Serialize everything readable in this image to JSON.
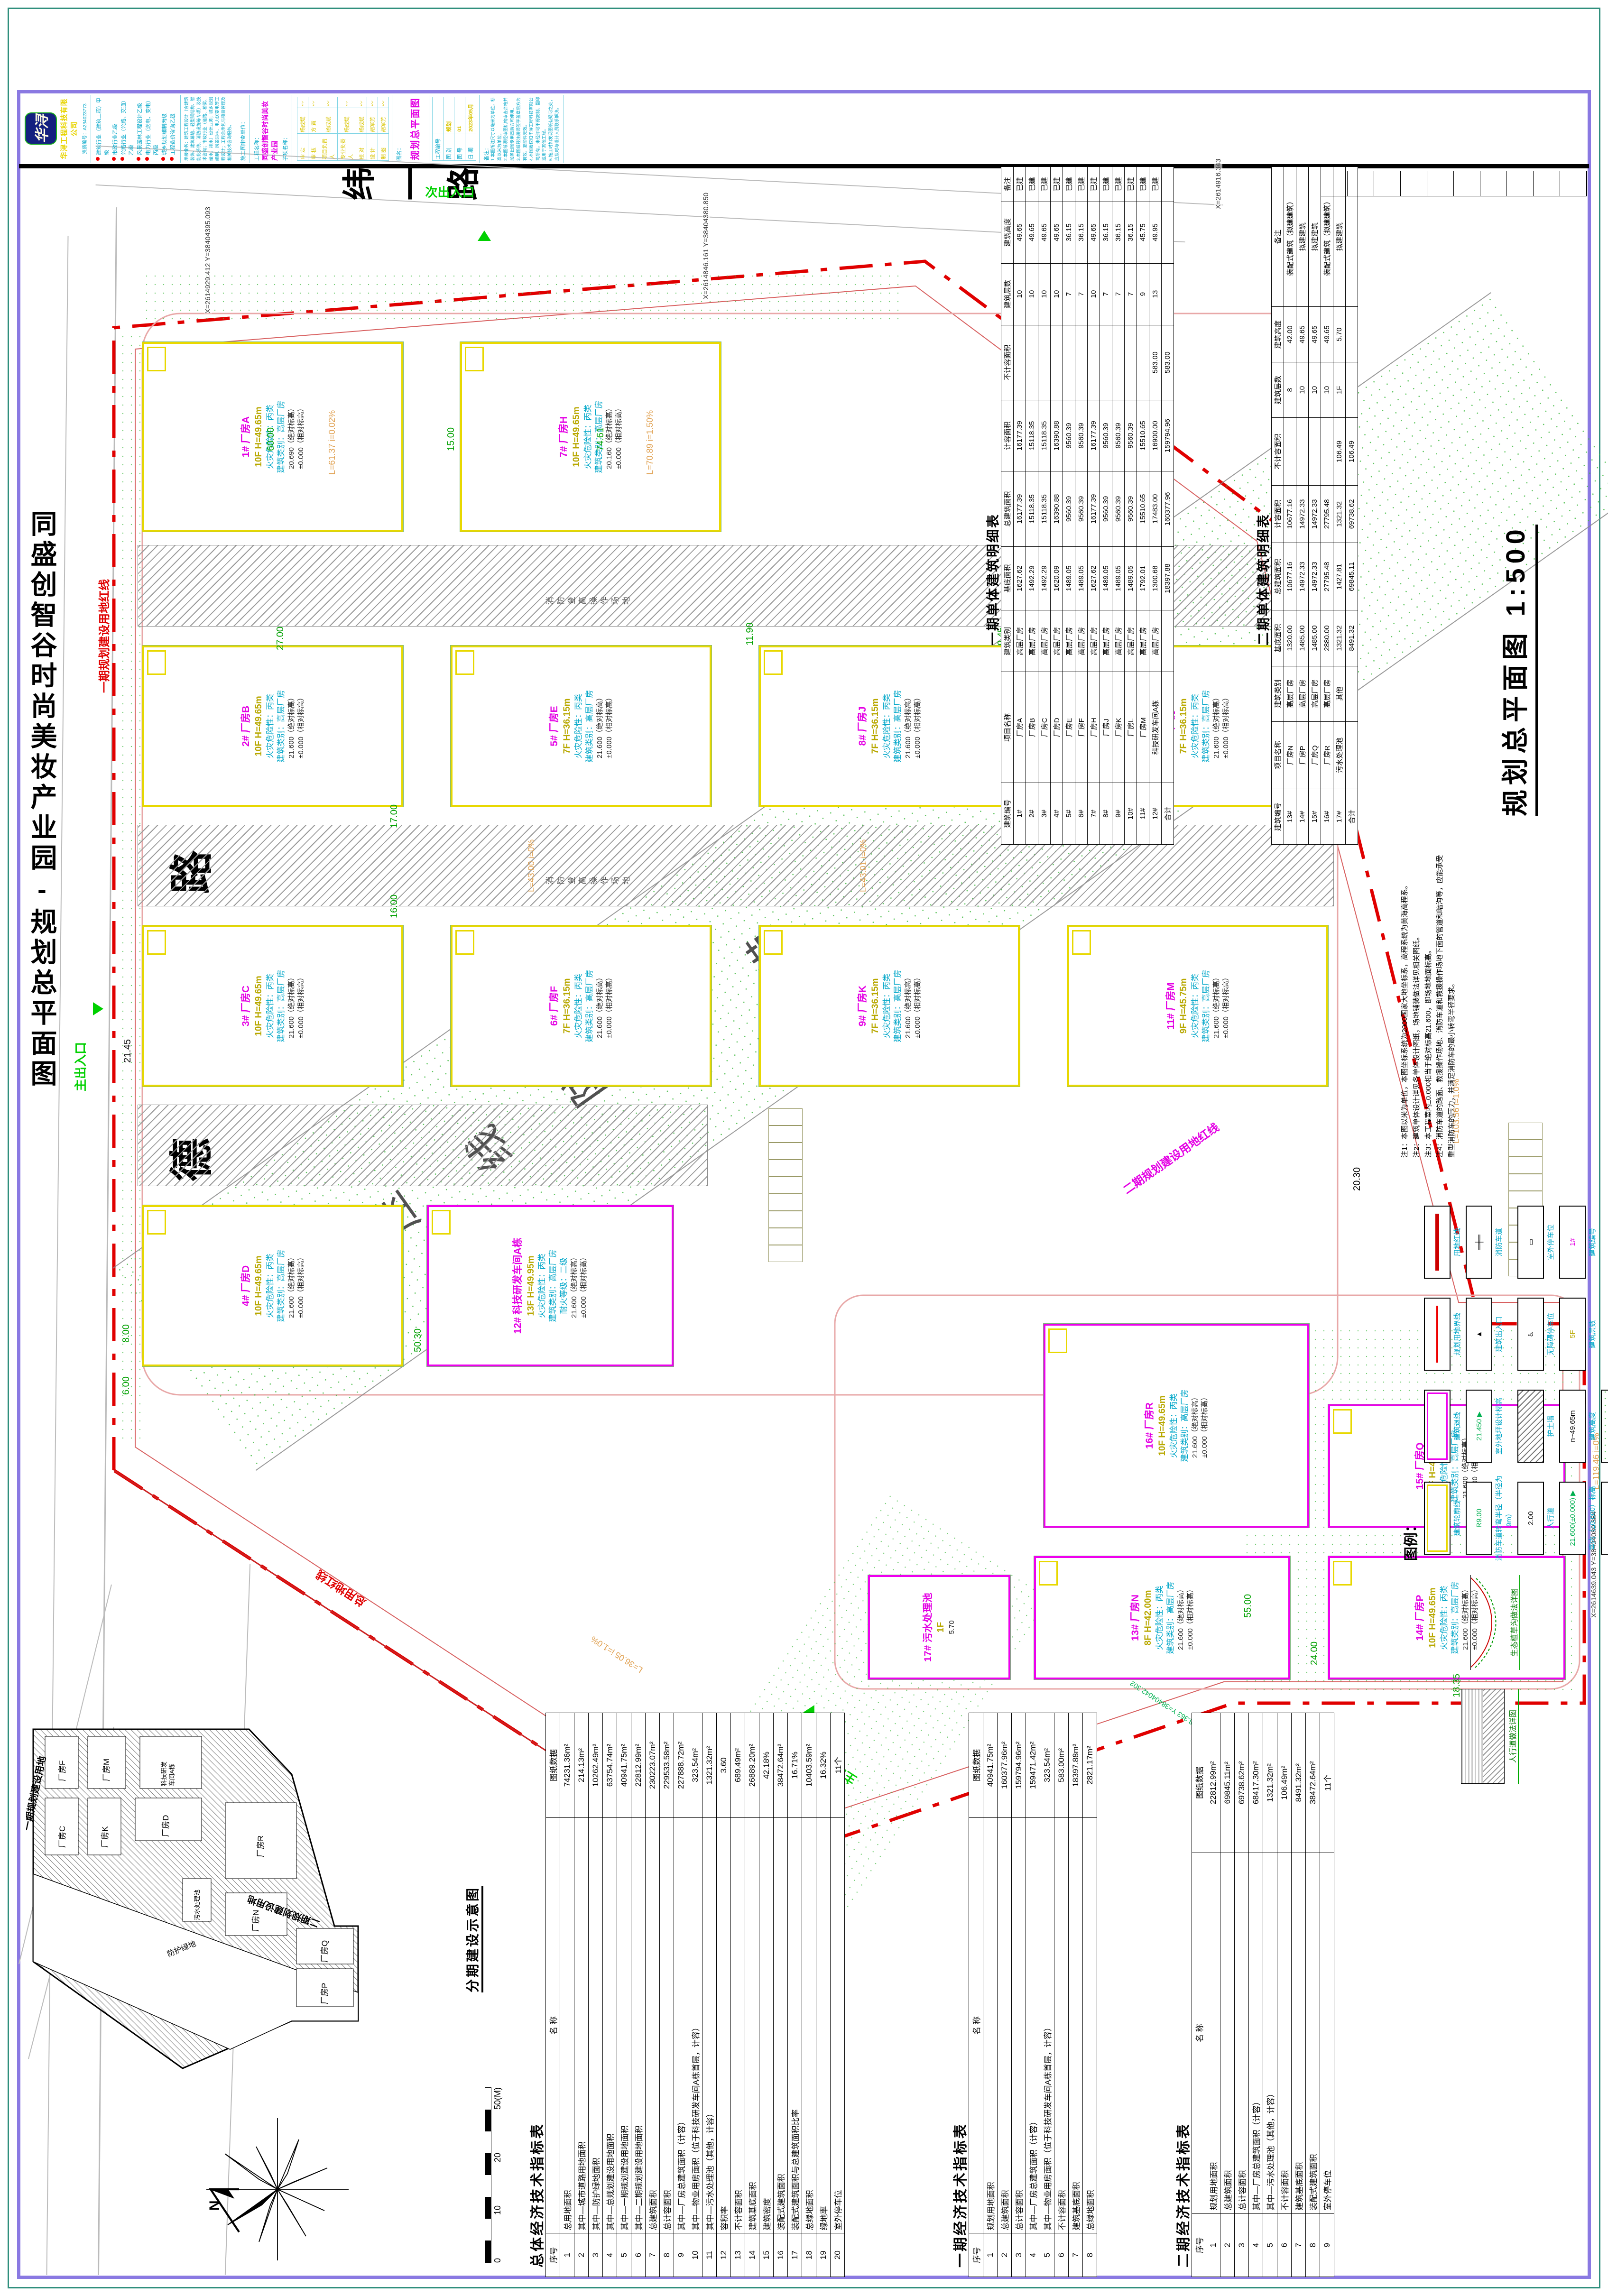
{
  "sheet": {
    "margin_title": "同盛创智谷时尚美妆产业园-规划总平面图",
    "plan_title": "规划总平面图 1:500"
  },
  "company": {
    "logo_text": "华浔",
    "name": "华浔工程科技有限公司",
    "reg_no": "资质编号：A234023773",
    "qualifications": [
      "建筑行业（建筑工程）甲级",
      "市政行业乙级",
      "公路行业（公路、交通）乙级",
      "风景园林工程设计乙级",
      "电力行业（送电、变电）丙级",
      "城乡规划编制丙级",
      "工程造价咨询乙级"
    ],
    "services": "承接业务：建筑工程设计（含建筑装饰、建筑幕墙、轻型钢结构、智能化系统、消防设施等专项）及技术咨询；市政行业（道路、桥梁、给水、排水）设计业务；城乡规划编制、风景园林、电力送变电等工程设计；工程总承包与项目管理及相关技术咨询服务。",
    "review_line": "施工图审查单位："
  },
  "titleblock": {
    "project_label": "工程名称：",
    "project_name": "同盛创智谷时尚美妆产业园",
    "subproject_label": "子项名称：",
    "roles": [
      {
        "label": "审  定",
        "name": "杨成斌"
      },
      {
        "label": "审  核",
        "name": "方  寅"
      },
      {
        "label": "项目负责人",
        "name": "杨成斌"
      },
      {
        "label": "专业负责人",
        "name": "杨成斌"
      },
      {
        "label": "校  对",
        "name": "杨成斌"
      },
      {
        "label": "设  计",
        "name": "胡军芳"
      },
      {
        "label": "制  图",
        "name": "胡军芳"
      }
    ],
    "drawing_name_label": "图名：",
    "drawing_name": "规划总平面图",
    "fields": [
      {
        "label": "工程编号",
        "value": ""
      },
      {
        "label": "图  别",
        "value": "规划"
      },
      {
        "label": "图  号",
        "value": "01"
      },
      {
        "label": "日  期",
        "value": "2023年05月"
      }
    ],
    "notes_label": "备注：",
    "notes": [
      "1.本图所注尺寸以毫米为单位，标高以米为单位。",
      "2.本图纸须经审图机构审查合格并加盖出图专用章后方可使用。",
      "3.本图纸经注册师签字盖章后方为有效，复印件无效。",
      "4.本图版权归华浔工程科技有限公司所有，未经许可不得复制、翻印或用于其他工程。",
      "5.施工时如发现图纸有疑问之处，应及时与设计人员联系解决。"
    ]
  },
  "plan": {
    "roads": {
      "main": "德宝东路",
      "side": "纬一路"
    },
    "corridor_label": "高压线防护带",
    "greenery_label": "绿化",
    "greenery_area": "4327.43m²",
    "fire_strip_label": "消防登高操作场地",
    "building_common": {
      "fire": "火灾危险性：丙类",
      "cls": "建筑类别：高层厂房",
      "abs_suffix": "（绝对标高）",
      "rel": "±0.000（相对标高）"
    },
    "buildings": [
      {
        "id": "b1",
        "num": "1#",
        "name": "厂房A",
        "floors": "10F",
        "height": "H=49.65m",
        "elev": "20.690",
        "phase": 1
      },
      {
        "id": "b2",
        "num": "2#",
        "name": "厂房B",
        "floors": "10F",
        "height": "H=49.65m",
        "elev": "21.600",
        "phase": 1
      },
      {
        "id": "b3",
        "num": "3#",
        "name": "厂房C",
        "floors": "10F",
        "height": "H=49.65m",
        "elev": "21.600",
        "phase": 1
      },
      {
        "id": "b4",
        "num": "4#",
        "name": "厂房D",
        "floors": "10F",
        "height": "H=49.65m",
        "elev": "21.600",
        "phase": 1
      },
      {
        "id": "b5",
        "num": "5#",
        "name": "厂房E",
        "floors": "7F",
        "height": "H=36.15m",
        "elev": "21.600",
        "phase": 1
      },
      {
        "id": "b6",
        "num": "6#",
        "name": "厂房F",
        "floors": "7F",
        "height": "H=36.15m",
        "elev": "21.600",
        "phase": 1
      },
      {
        "id": "b7",
        "num": "7#",
        "name": "厂房H",
        "floors": "10F",
        "height": "H=49.65m",
        "elev": "20.160",
        "phase": 1
      },
      {
        "id": "b8",
        "num": "8#",
        "name": "厂房J",
        "floors": "7F",
        "height": "H=36.15m",
        "elev": "21.600",
        "phase": 1
      },
      {
        "id": "b9",
        "num": "9#",
        "name": "厂房K",
        "floors": "7F",
        "height": "H=36.15m",
        "elev": "21.600",
        "phase": 1
      },
      {
        "id": "b10",
        "num": "10#",
        "name": "厂房L",
        "floors": "7F",
        "height": "H=36.15m",
        "elev": "21.600",
        "phase": 1
      },
      {
        "id": "b11",
        "num": "11#",
        "name": "厂房M",
        "floors": "9F",
        "height": "H=45.75m",
        "elev": "21.600",
        "phase": 1
      },
      {
        "id": "b12",
        "num": "12#",
        "name": "科技研发车间A栋",
        "floors": "13F",
        "height": "H=49.95m",
        "elev": "21.600",
        "phase": 1,
        "extra": "耐火等级：二级",
        "m": true
      },
      {
        "id": "b13",
        "num": "13#",
        "name": "厂房N",
        "floors": "8F",
        "height": "H=42.00m",
        "elev": "21.600",
        "phase": 2
      },
      {
        "id": "b14",
        "num": "14#",
        "name": "厂房P",
        "floors": "10F",
        "height": "H=49.65m",
        "elev": "21.600",
        "phase": 2
      },
      {
        "id": "b15",
        "num": "15#",
        "name": "厂房Q",
        "floors": "10F",
        "height": "H=49.65m",
        "elev": "21.600",
        "phase": 2
      },
      {
        "id": "b16",
        "num": "16#",
        "name": "厂房R",
        "floors": "10F",
        "height": "H=49.65m",
        "elev": "21.600",
        "phase": 2
      },
      {
        "id": "b17",
        "num": "17#",
        "name": "污水处理池",
        "floors": "1F",
        "height": "5.70",
        "elev": "",
        "phase": 2,
        "t": "pond"
      }
    ],
    "annotations": [
      {
        "t": "6.00",
        "k": "dim"
      },
      {
        "t": "8.00",
        "k": "dim"
      },
      {
        "t": "60.00",
        "k": "dim"
      },
      {
        "t": "15.00",
        "k": "dim"
      },
      {
        "t": "74.61",
        "k": "dim"
      },
      {
        "t": "27.00",
        "k": "dim"
      },
      {
        "t": "17.00",
        "k": "dim"
      },
      {
        "t": "16.00",
        "k": "dim"
      },
      {
        "t": "55.00",
        "k": "dim"
      },
      {
        "t": "11.90",
        "k": "dim"
      },
      {
        "t": "9.45",
        "k": "dim"
      },
      {
        "t": "50.30",
        "k": "dim"
      },
      {
        "t": "24.00",
        "k": "dim"
      },
      {
        "t": "55.00",
        "k": "dim"
      },
      {
        "t": "18.35",
        "k": "dim"
      },
      {
        "t": "21.45",
        "k": "blk"
      },
      {
        "t": "20.30",
        "k": "blk"
      },
      {
        "t": "L=61.37 i=0.02%",
        "k": "orange"
      },
      {
        "t": "L=70.89 i=1.50%",
        "k": "orange"
      },
      {
        "t": "L=43.00 i=0%",
        "k": "orange"
      },
      {
        "t": "L=43.01 i=0%",
        "k": "orange"
      },
      {
        "t": "L=103.56 i=1.0%",
        "k": "orange"
      },
      {
        "t": "L=119.46 i=0%",
        "k": "orange"
      },
      {
        "t": "L=36.05 i=1.0%",
        "k": "orange"
      },
      {
        "t": "X=2614929.412 Y=38404395.093",
        "k": "coord"
      },
      {
        "t": "X=2614846.161 Y=38404380.850",
        "k": "coord"
      },
      {
        "t": "X=2614785.881 Y=38404382.414",
        "k": "coord"
      },
      {
        "t": "X=2614916.343",
        "k": "coord"
      },
      {
        "t": "X=2614758.363 Y=38404042.302",
        "k": "coordg"
      },
      {
        "t": "X=2614639.043 Y=38404080.384",
        "k": "coord"
      },
      {
        "t": "一期规划建设用地红线",
        "k": "redl"
      },
      {
        "t": "总用地红线",
        "k": "redl"
      },
      {
        "t": "二期规划建设用地红线",
        "k": "mgl"
      },
      {
        "t": "主出入口",
        "k": "entr"
      },
      {
        "t": "次出入口",
        "k": "entr"
      },
      {
        "t": "主出入口",
        "k": "entr"
      }
    ]
  },
  "tables": {
    "overall": {
      "title": "总体经济技术指标表",
      "headers": [
        "序号",
        "名  称",
        "图纸数据"
      ],
      "rows": [
        [
          "1",
          "总用地面积",
          "74231.36m²"
        ],
        [
          "2",
          "其中—城市道路用地面积",
          "214.13m²"
        ],
        [
          "3",
          "其中—防护绿地面积",
          "10262.49m²"
        ],
        [
          "4",
          "其中—总规划建设用地面积",
          "63754.74m²"
        ],
        [
          "5",
          "其中—一期规划建设用地面积",
          "40941.75m²"
        ],
        [
          "6",
          "其中—二期规划建设用地面积",
          "22812.99m²"
        ],
        [
          "7",
          "总建筑面积",
          "230223.07m²"
        ],
        [
          "8",
          "总计容面积",
          "229533.58m²"
        ],
        [
          "9",
          "其中—厂房总建筑面积（计容）",
          "227888.72m²"
        ],
        [
          "10",
          "其中—物业用房面积（位于科技研发车间A栋首层，计容）",
          "323.54m²"
        ],
        [
          "11",
          "其中—污水处理池（其他，计容）",
          "1321.32m²"
        ],
        [
          "12",
          "容积率",
          "3.60"
        ],
        [
          "13",
          "不计容面积",
          "689.49m²"
        ],
        [
          "14",
          "建筑基底面积",
          "26889.20m²"
        ],
        [
          "15",
          "建筑密度",
          "42.18%"
        ],
        [
          "16",
          "装配式建筑面积",
          "38472.64m²"
        ],
        [
          "17",
          "装配式建筑面积与总建筑面积比率",
          "16.71%"
        ],
        [
          "18",
          "总绿地面积",
          "10403.59m²"
        ],
        [
          "19",
          "绿地率",
          "16.32%"
        ],
        [
          "20",
          "室外停车位",
          "11个"
        ]
      ]
    },
    "phase1": {
      "title": "一期经济技术指标表",
      "headers": [
        "序号",
        "名  称",
        "图纸数据"
      ],
      "rows": [
        [
          "1",
          "规划用地面积",
          "40941.75m²"
        ],
        [
          "2",
          "总建筑面积",
          "160377.96m²"
        ],
        [
          "3",
          "总计容面积",
          "159794.96m²"
        ],
        [
          "4",
          "其中—厂房总建筑面积（计容）",
          "159471.42m²"
        ],
        [
          "5",
          "其中—物业用房面积（位于科技研发车间A栋首层，计容）",
          "323.54m²"
        ],
        [
          "6",
          "不计容面积",
          "583.00m²"
        ],
        [
          "7",
          "建筑基底面积",
          "18397.88m²"
        ],
        [
          "8",
          "总绿地面积",
          "2821.17m²"
        ]
      ]
    },
    "phase2": {
      "title": "二期经济技术指标表",
      "headers": [
        "序号",
        "名  称",
        "图纸数据"
      ],
      "rows": [
        [
          "1",
          "规划用地面积",
          "22812.99m²"
        ],
        [
          "2",
          "总建筑面积",
          "69845.11m²"
        ],
        [
          "3",
          "总计容面积",
          "69738.62m²"
        ],
        [
          "4",
          "其中—厂房总建筑面积（计容）",
          "68417.30m²"
        ],
        [
          "5",
          "其中—污水处理池（其他，计容）",
          "1321.32m²"
        ],
        [
          "6",
          "不计容面积",
          "106.49m²"
        ],
        [
          "7",
          "建筑基底面积",
          "8491.32m²"
        ],
        [
          "8",
          "装配式建筑面积",
          "38472.64m²"
        ],
        [
          "9",
          "室外停车位",
          "11个"
        ]
      ]
    },
    "detail1": {
      "title": "一期单体建筑明细表",
      "headers": [
        "建筑编号",
        "项目名称",
        "建筑类别",
        "基底面积",
        "总建筑面积",
        "计容面积",
        "不计容面积",
        "建筑层数",
        "建筑高度",
        "备注"
      ],
      "rows": [
        [
          "1#",
          "厂房A",
          "高层厂房",
          "1627.62",
          "16177.39",
          "16177.39",
          "",
          "10",
          "49.65",
          "已建"
        ],
        [
          "2#",
          "厂房B",
          "高层厂房",
          "1492.29",
          "15118.35",
          "15118.35",
          "",
          "10",
          "49.65",
          "已建"
        ],
        [
          "3#",
          "厂房C",
          "高层厂房",
          "1492.29",
          "15118.35",
          "15118.35",
          "",
          "10",
          "49.65",
          "已建"
        ],
        [
          "4#",
          "厂房D",
          "高层厂房",
          "1620.09",
          "16390.88",
          "16390.88",
          "",
          "10",
          "49.65",
          "已建"
        ],
        [
          "5#",
          "厂房E",
          "高层厂房",
          "1489.05",
          "9560.39",
          "9560.39",
          "",
          "7",
          "36.15",
          "已建"
        ],
        [
          "6#",
          "厂房F",
          "高层厂房",
          "1489.05",
          "9560.39",
          "9560.39",
          "",
          "7",
          "36.15",
          "已建"
        ],
        [
          "7#",
          "厂房H",
          "高层厂房",
          "1627.62",
          "16177.39",
          "16177.39",
          "",
          "10",
          "49.65",
          "已建"
        ],
        [
          "8#",
          "厂房J",
          "高层厂房",
          "1489.05",
          "9560.39",
          "9560.39",
          "",
          "7",
          "36.15",
          "已建"
        ],
        [
          "9#",
          "厂房K",
          "高层厂房",
          "1489.05",
          "9560.39",
          "9560.39",
          "",
          "7",
          "36.15",
          "已建"
        ],
        [
          "10#",
          "厂房L",
          "高层厂房",
          "1489.05",
          "9560.39",
          "9560.39",
          "",
          "7",
          "36.15",
          "已建"
        ],
        [
          "11#",
          "厂房M",
          "高层厂房",
          "1792.01",
          "15510.65",
          "15510.65",
          "",
          "9",
          "45.75",
          "已建"
        ],
        [
          "12#",
          "科技研发车间A栋",
          "高层厂房",
          "1300.68",
          "17483.00",
          "16900.00",
          "583.00",
          "13",
          "49.95",
          "已建"
        ],
        [
          "合计",
          "",
          "",
          "18397.88",
          "160377.96",
          "159794.96",
          "583.00",
          "",
          "",
          ""
        ]
      ]
    },
    "detail2": {
      "title": "二期单体建筑明细表",
      "headers": [
        "建筑编号",
        "项目名称",
        "建筑类别",
        "基底面积",
        "总建筑面积",
        "计容面积",
        "不计容面积",
        "建筑层数",
        "建筑高度",
        "备注"
      ],
      "rows": [
        [
          "13#",
          "厂房N",
          "高层厂房",
          "1320.00",
          "10677.16",
          "10677.16",
          "",
          "8",
          "42.00",
          "装配式建筑（拟建建筑）"
        ],
        [
          "14#",
          "厂房P",
          "高层厂房",
          "1485.00",
          "14972.33",
          "14972.33",
          "",
          "10",
          "49.65",
          "拟建建筑"
        ],
        [
          "15#",
          "厂房Q",
          "高层厂房",
          "1485.00",
          "14972.33",
          "14972.33",
          "",
          "10",
          "49.65",
          "拟建建筑"
        ],
        [
          "16#",
          "厂房R",
          "高层厂房",
          "2880.00",
          "27795.48",
          "27795.48",
          "",
          "10",
          "49.65",
          "装配式建筑（拟建建筑）"
        ],
        [
          "17#",
          "污水处理池",
          "其他",
          "1321.32",
          "1427.81",
          "1321.32",
          "106.49",
          "1F",
          "5.70",
          "拟建建筑"
        ],
        [
          "合计",
          "",
          "",
          "8491.32",
          "69845.11",
          "69738.62",
          "106.49",
          "",
          "",
          ""
        ]
      ]
    }
  },
  "keyplan": {
    "title": "分期建设示意图",
    "phase1_label": "一期规划建设用地",
    "phase2_label": "二期规划建设用地",
    "band_label": "防护绿地",
    "buildings": [
      "厂房C",
      "厂房F",
      "厂房K",
      "厂房M",
      "厂房D",
      "科技研发车间A栋",
      "污水处理池",
      "厂房N",
      "厂房R",
      "厂房P",
      "厂房Q"
    ]
  },
  "scalebar": {
    "labels": [
      "0",
      "10",
      "20",
      "50(M)"
    ]
  },
  "compass": {
    "north": "N"
  },
  "legend": {
    "title": "图例：",
    "items": [
      {
        "sym": "yellow-rect",
        "txt": "",
        "label": "建筑轮廓线"
      },
      {
        "sym": "magenta-rect",
        "txt": "",
        "label": "建筑退线"
      },
      {
        "sym": "red-line",
        "txt": "",
        "label": "规划用地界线"
      },
      {
        "sym": "red-thick",
        "txt": "",
        "label": "用地红线"
      },
      {
        "sym": "radius",
        "txt": "R9.00",
        "label": "消防车道转弯半径（半径为9m）"
      },
      {
        "sym": "elev-out",
        "txt": "21.450 ▶",
        "label": "室外地坪设计标高"
      },
      {
        "sym": "entry",
        "txt": "▲",
        "label": "建筑出入口"
      },
      {
        "sym": "fire-lane",
        "txt": "═╪═",
        "label": "消防车道"
      },
      {
        "sym": "sidewalk",
        "txt": "2.00",
        "label": "人行道"
      },
      {
        "sym": "wall",
        "txt": "",
        "label": "护土墙"
      },
      {
        "sym": "access",
        "txt": "♿",
        "label": "无障碍停车位"
      },
      {
        "sym": "stall",
        "txt": "▭",
        "label": "室外停车位"
      },
      {
        "sym": "elev-in",
        "txt": "21.600(±0.000) ▶",
        "label": "室内（±0.000）标高"
      },
      {
        "sym": "height",
        "txt": "n~49.65m",
        "label": "建筑高度"
      },
      {
        "sym": "floors",
        "txt": "5F",
        "label": "建筑层数"
      },
      {
        "sym": "bnum",
        "txt": "1#",
        "label": "建筑编号"
      },
      {
        "sym": "slope",
        "txt": "64.50 0.76%",
        "label": "坡长与坡度"
      },
      {
        "sym": "green-spk",
        "txt": "",
        "label": "绿化用地"
      }
    ]
  },
  "plan_notes": [
    "注1：本图以米为单位，本图坐标系统为2000国家大地坐标系，高程系统为黄海高程系。",
    "注2：建筑单体设计详见各单体设计图纸，场地铺装做法详见相关图纸。",
    "注3：本工程室内±0.000相当于绝对标高21.600，即场地地面标高。",
    "注4：消防车道的路面、救援操作场地、消防车道和救援操作场地下面的管道和暗沟等，应能承受重型消防车的压力，并满足消防车的最小转弯半径要求。"
  ],
  "details": [
    {
      "caption": "人行道做法详图",
      "layers": [
        "面层铺装",
        "级配碎石垫层"
      ]
    },
    {
      "caption": "生态植草沟做法详图",
      "layers": []
    }
  ]
}
